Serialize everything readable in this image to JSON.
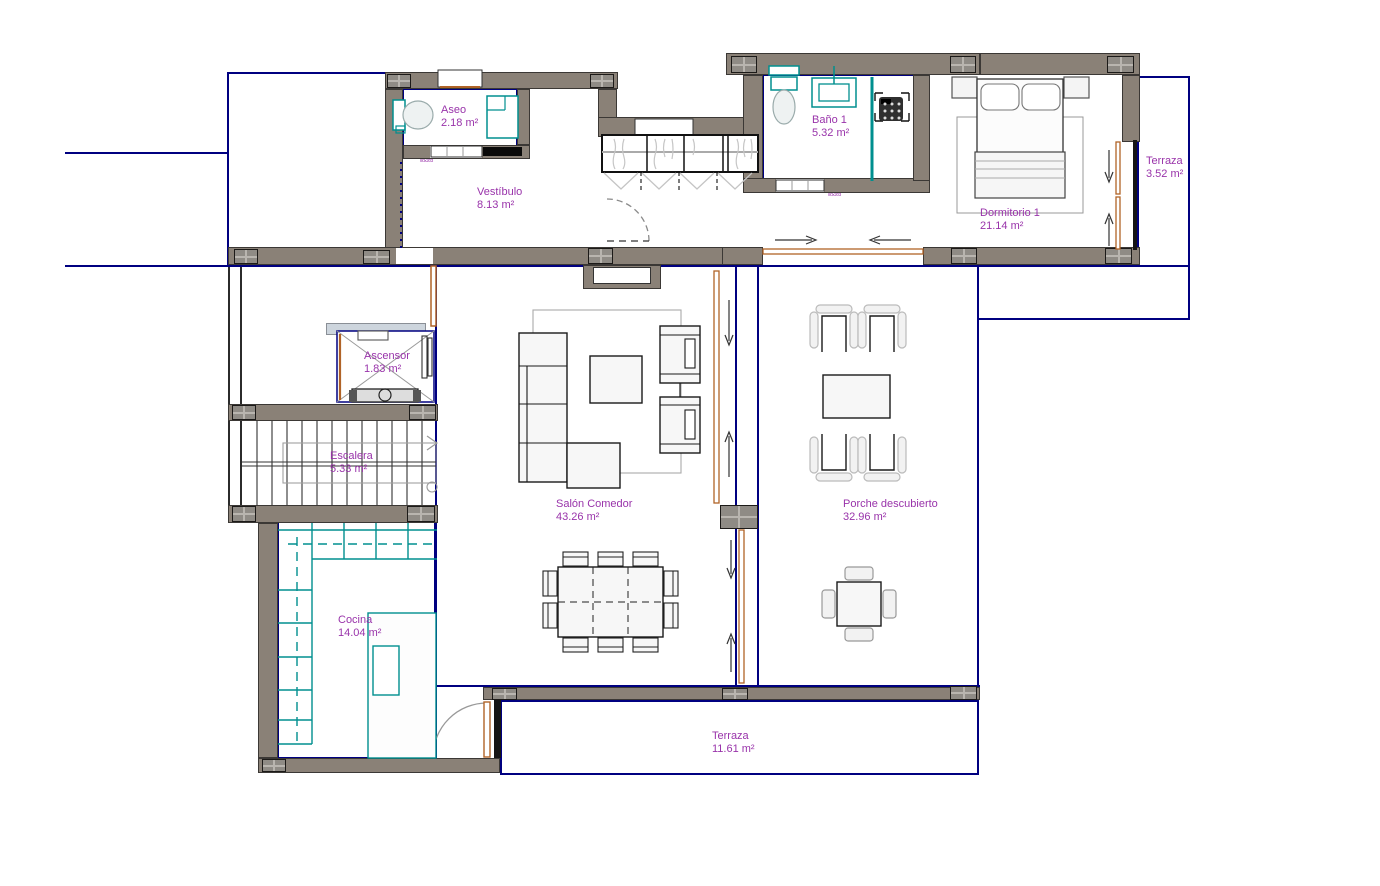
{
  "plan": {
    "rooms": [
      {
        "name": "Aseo",
        "area": "2.18 m²"
      },
      {
        "name": "Vestíbulo",
        "area": "8.13 m²"
      },
      {
        "name": "Baño 1",
        "area": "5.32 m²"
      },
      {
        "name": "Terraza",
        "area": "3.52 m²"
      },
      {
        "name": "Dormitorio 1",
        "area": "21.14 m²"
      },
      {
        "name": "Ascensor",
        "area": "1.83 m²"
      },
      {
        "name": "Escalera",
        "area": "5.33 m²"
      },
      {
        "name": "Salón Comedor",
        "area": "43.26 m²"
      },
      {
        "name": "Porche descubierto",
        "area": "32.96 m²"
      },
      {
        "name": "Cocina",
        "area": "14.04 m²"
      },
      {
        "name": "Terraza",
        "area": "11.61 m²"
      }
    ],
    "door_tag": "80x203",
    "colors": {
      "label": "#9933aa",
      "wall": "#8a8177",
      "boundary": "#000080",
      "fixture": "#008f8f",
      "door": "#b06327"
    }
  }
}
